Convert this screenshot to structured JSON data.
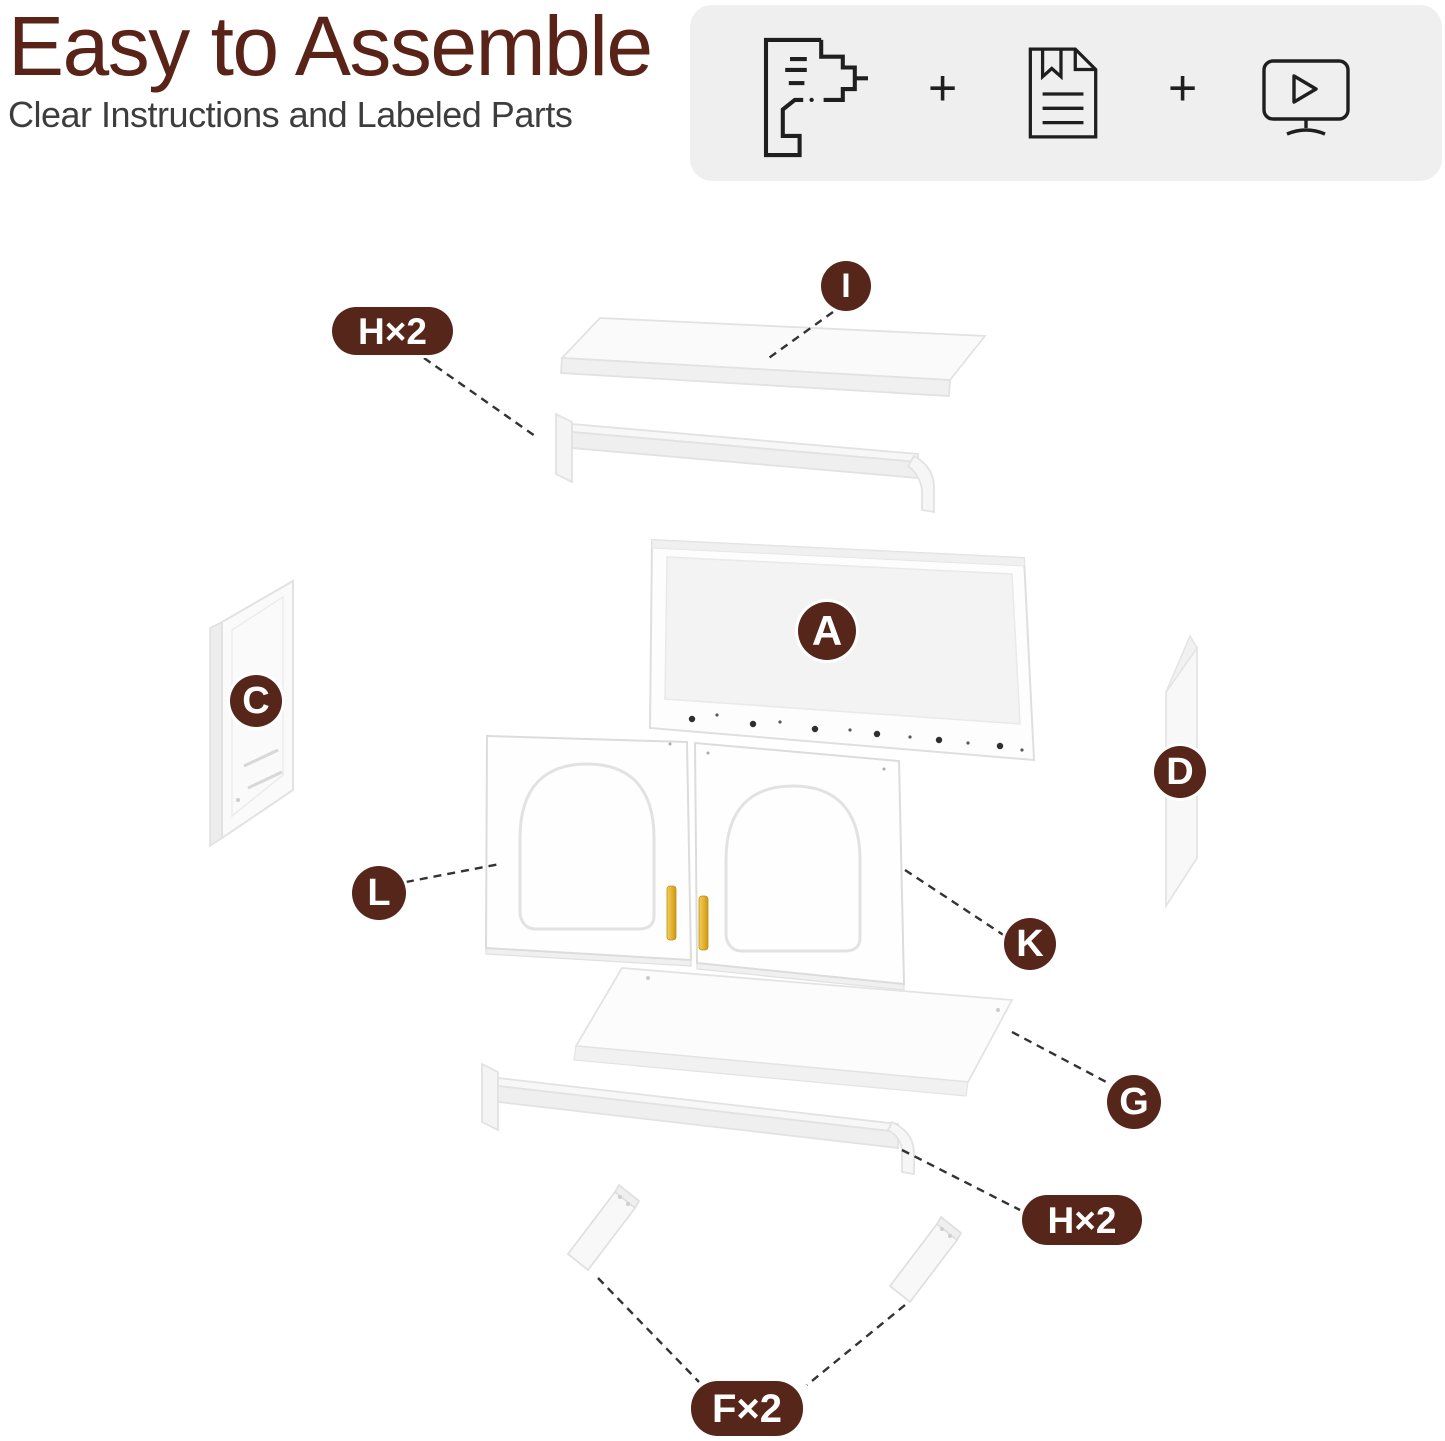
{
  "header": {
    "title": "Easy to Assemble",
    "subtitle": "Clear Instructions and Labeled Parts"
  },
  "feature_box": {
    "separator": "+",
    "icons": [
      {
        "name": "drill-icon"
      },
      {
        "name": "manual-icon"
      },
      {
        "name": "video-tutorial-icon"
      }
    ]
  },
  "diagram": {
    "labels": [
      {
        "id": "H-top",
        "text": "H×2"
      },
      {
        "id": "I",
        "text": "I"
      },
      {
        "id": "A",
        "text": "A"
      },
      {
        "id": "C",
        "text": "C"
      },
      {
        "id": "D",
        "text": "D"
      },
      {
        "id": "L",
        "text": "L"
      },
      {
        "id": "K",
        "text": "K"
      },
      {
        "id": "G",
        "text": "G"
      },
      {
        "id": "H-bottom",
        "text": "H×2"
      },
      {
        "id": "F",
        "text": "F×2"
      }
    ]
  },
  "colors": {
    "accent": "#57261A",
    "title": "#5A2318",
    "subtitle": "#3D3D3D",
    "feature_box_bg": "#EFEFEF",
    "icon_stroke": "#1F1F1F",
    "handle_gold": "#E3AE2E"
  }
}
